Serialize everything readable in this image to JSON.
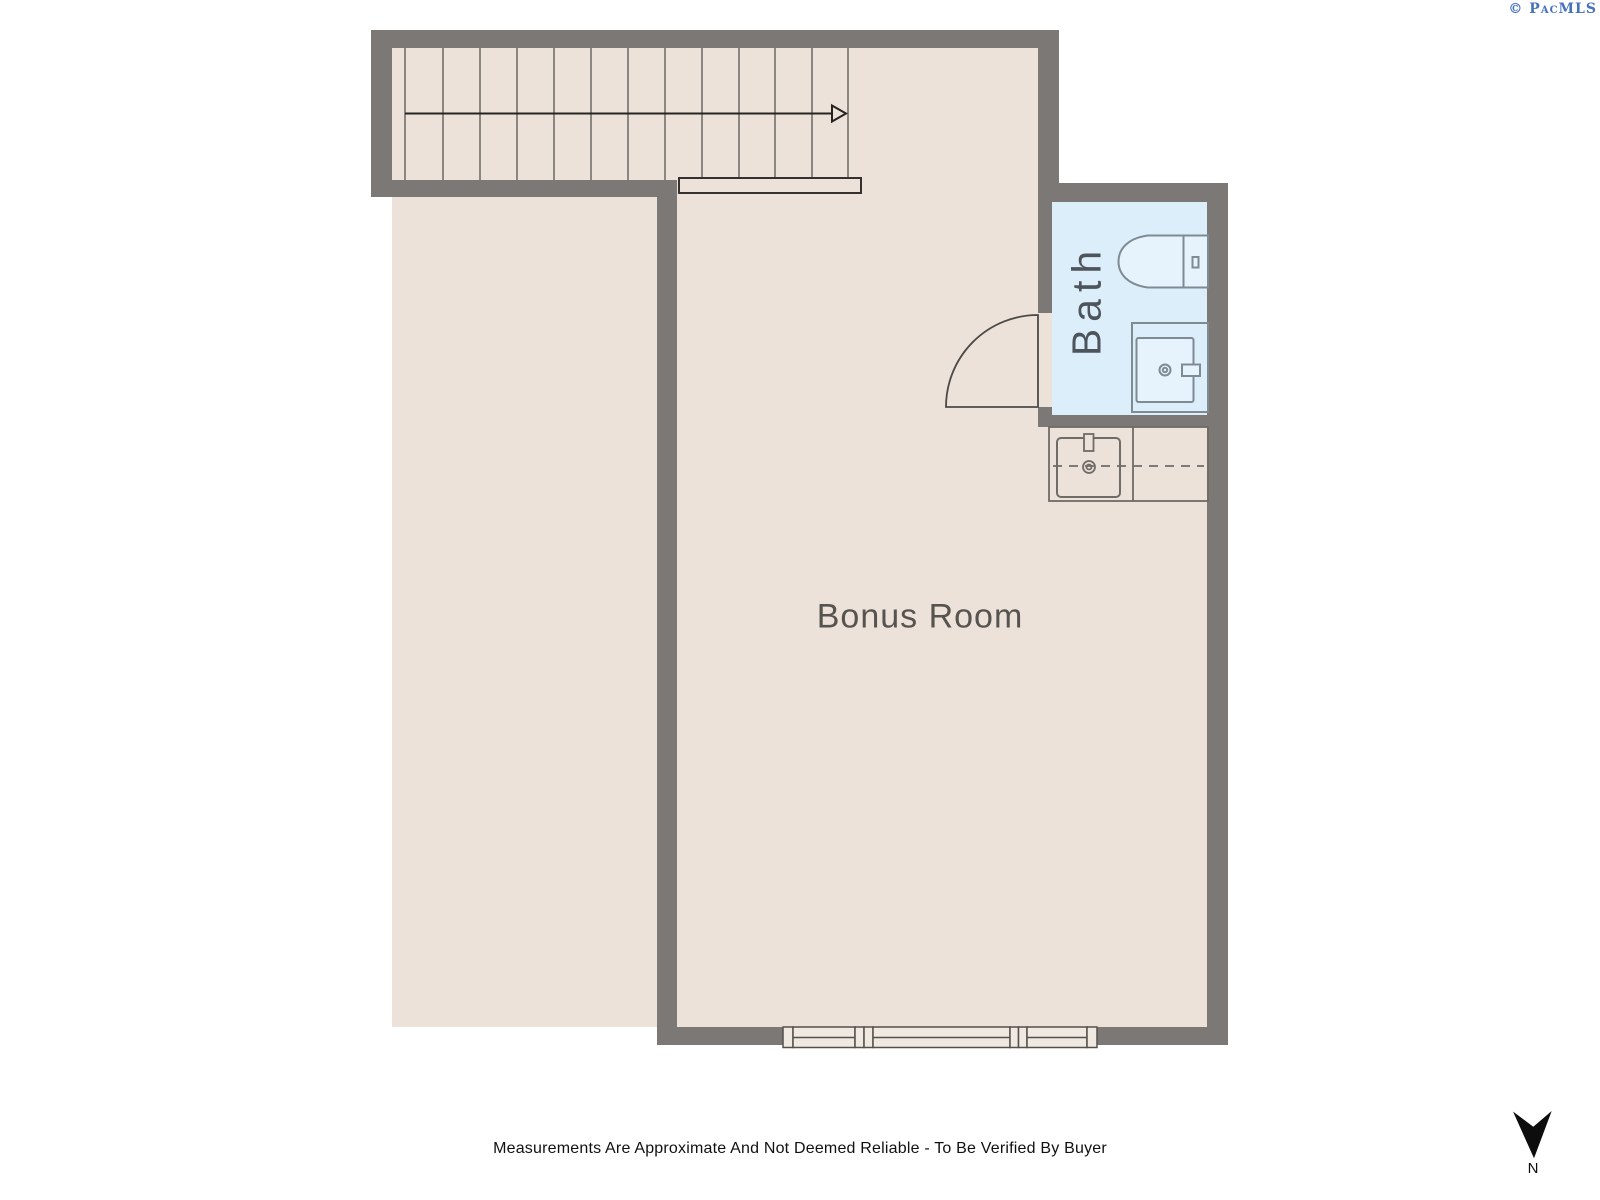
{
  "watermark": {
    "text": "© PacMLS"
  },
  "rooms": {
    "bonus": {
      "name": "Bonus Room"
    },
    "bath": {
      "name": "Bath"
    }
  },
  "fixtures": {
    "stairs": "staircase-with-direction-arrow",
    "railing": "stair-railing",
    "door": "door-swing-quarter-arc",
    "toilet": "toilet",
    "shower": "shower-with-drain",
    "vanity": "vanity-counter-with-sink",
    "window": "triple-window"
  },
  "compass": {
    "label": "N",
    "direction": "down"
  },
  "footer": {
    "disclaimer": "Measurements Are Approximate And Not Deemed Reliable - To Be Verified By Buyer"
  },
  "colors": {
    "wall": "#7b7875",
    "floor": "#ece2da",
    "bath_floor": "#dceefa",
    "fixture_fill": "#e7f3fc",
    "fixture_stroke": "#7e8a94",
    "tread_line": "#6b6763",
    "counter_line": "#6f6b67",
    "window_fill": "#f0e9e2",
    "label_text": "#57534f",
    "bath_text": "#4d545c",
    "disclaimer_text": "#111111",
    "watermark_blue": "#4671bd",
    "compass_black": "#0d0d0d"
  }
}
